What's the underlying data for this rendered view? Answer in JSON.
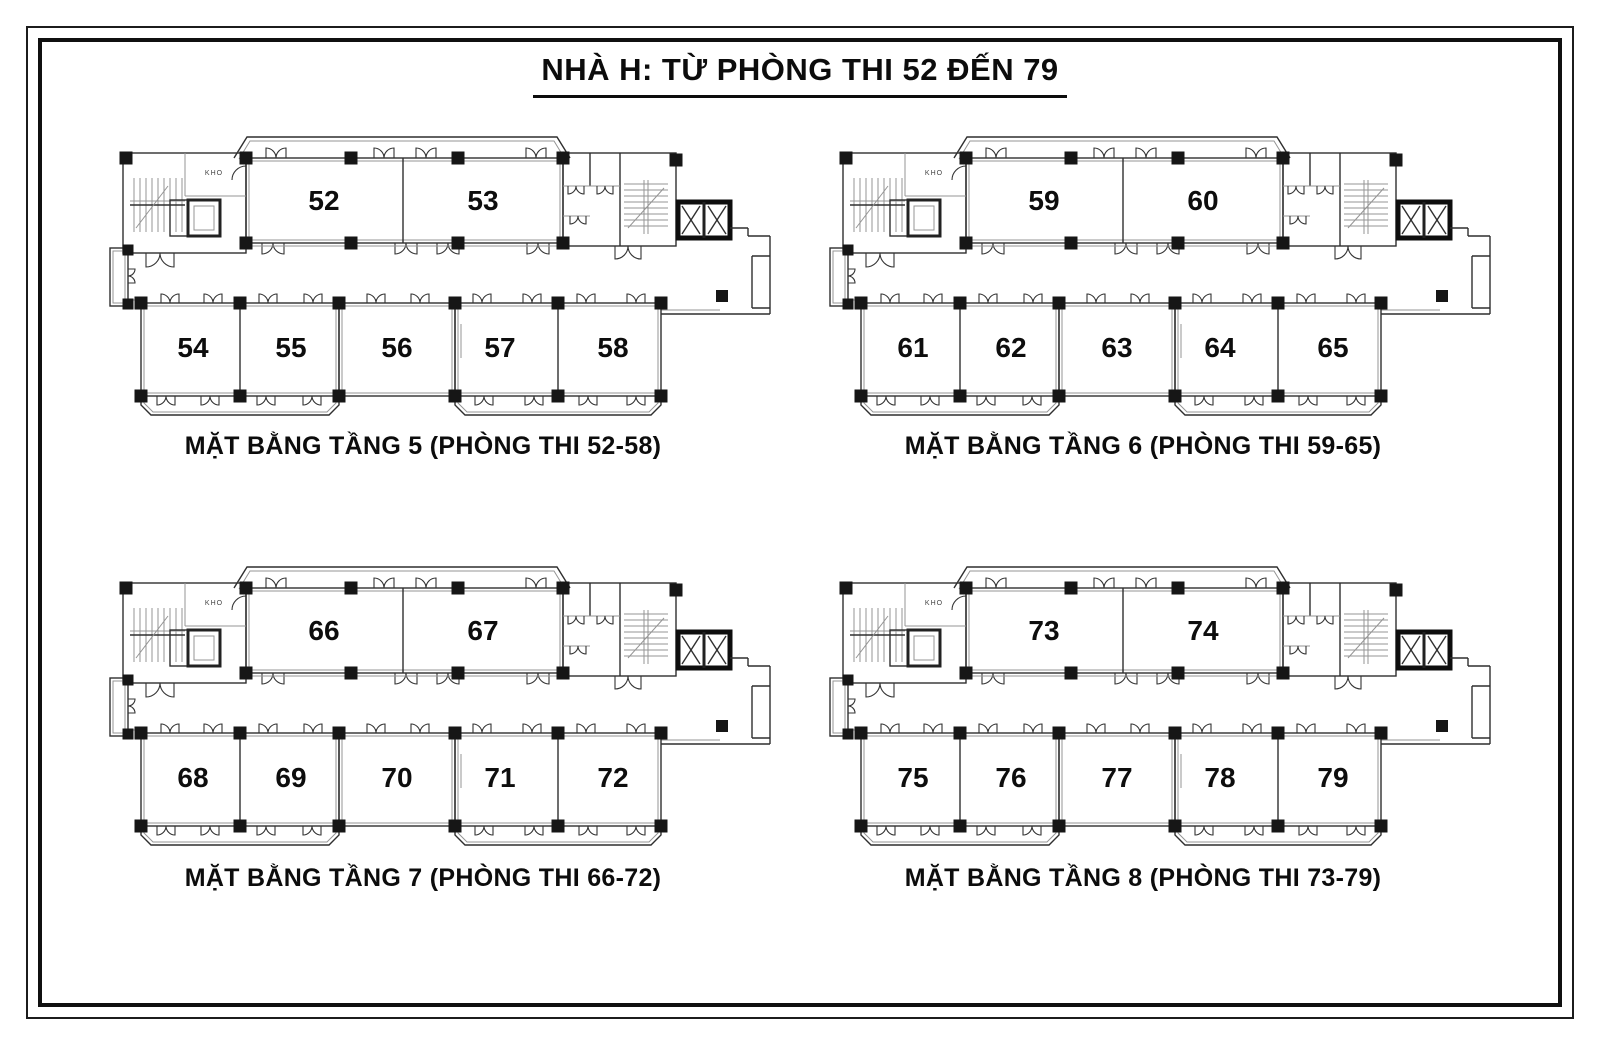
{
  "page": {
    "title": "NHÀ H: TỪ PHÒNG THI 52 ĐẾN 79"
  },
  "storage_label": "KHO",
  "floors": [
    {
      "caption": "MẶT BẰNG TẦNG 5 (PHÒNG THI 52-58)",
      "top_rooms": [
        "52",
        "53"
      ],
      "bottom_rooms": [
        "54",
        "55",
        "56",
        "57",
        "58"
      ]
    },
    {
      "caption": "MẶT BẰNG TẦNG 6 (PHÒNG THI 59-65)",
      "top_rooms": [
        "59",
        "60"
      ],
      "bottom_rooms": [
        "61",
        "62",
        "63",
        "64",
        "65"
      ]
    },
    {
      "caption": "MẶT BẰNG TẦNG 7 (PHÒNG THI 66-72)",
      "top_rooms": [
        "66",
        "67"
      ],
      "bottom_rooms": [
        "68",
        "69",
        "70",
        "71",
        "72"
      ]
    },
    {
      "caption": "MẶT BẰNG TẦNG 8 (PHÒNG THI 73-79)",
      "top_rooms": [
        "73",
        "74"
      ],
      "bottom_rooms": [
        "75",
        "76",
        "77",
        "78",
        "79"
      ]
    }
  ],
  "colors": {
    "ink": "#0c0c0c",
    "wall": "#2f2f2f",
    "thin_line": "#949494",
    "background": "#ffffff"
  }
}
